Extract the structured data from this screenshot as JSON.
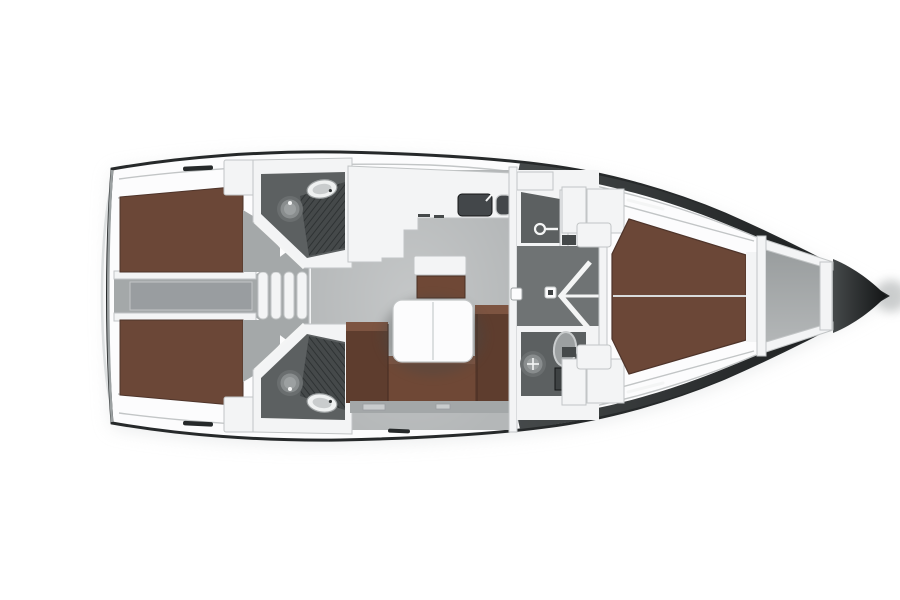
{
  "scene": {
    "type": "yacht-deck-plan",
    "orientation": "bow-right",
    "rooms": [
      "aft-cabin-port",
      "aft-cabin-starboard",
      "companionway-steps",
      "aft-head-port",
      "aft-head-starboard",
      "galley",
      "salon",
      "shower-compartment",
      "forward-head",
      "forward-cabin",
      "anchor-locker"
    ]
  },
  "canvas": {
    "width": 900,
    "height": 600,
    "background": "#ffffff"
  },
  "colors": {
    "bg": "#ffffff",
    "hull_line": "#26292a",
    "hull_dark": "#141617",
    "rim_mid": "#45494a",
    "stern_edge": "#9ba0a1",
    "transom": "#dcdfe0",
    "shadow": "#d9dcdd",
    "deck_white": "#fcfcfd",
    "wall_white": "#f3f4f5",
    "wall_line": "#c2c5c6",
    "salon_floor": "#b4b7b8",
    "corridor_floor": "#a4a8a9",
    "engine_panel": "#999da0",
    "bed_brown": "#6b4737",
    "bed_dark": "#4e342a",
    "bed_seam": "#d9dcdc",
    "sofa_brown": "#6f4836",
    "sofa_dark": "#5e3d2e",
    "sofa_light": "#7d5441",
    "sofa_seam": "#4a3024",
    "locker_gray": "#a3a7a8",
    "handle_gray": "#c9cccd",
    "head_floor": "#5c6061",
    "grate_bg": "#45494a",
    "grate_line": "#2f3334",
    "fixture_dark": "#6a6e6f",
    "fixture_mid": "#898d8e",
    "fixture_light": "#9ca0a1",
    "cabinet_dark": "#3e4243",
    "passage_floor": "#6f7374",
    "anchor_gray_a": "#999d9e",
    "anchor_gray_b": "#b3b6b7",
    "icon_white": "#f4f5f5",
    "sink_basin": "#eff1f1",
    "sink_rim": "#9ea2a3",
    "galley_sink": "#43474a"
  },
  "icons": {
    "toilet": "concentric-circles-glyph",
    "sink": "oval-basin-glyph",
    "shower": "circle-with-hose-glyph",
    "door_swing": "chevron-glyph",
    "companionway_steps": "capsule-treads-glyph",
    "deck_hatch": "dark-dash-glyph",
    "toe_rail_slot": "white-dash-glyph"
  }
}
